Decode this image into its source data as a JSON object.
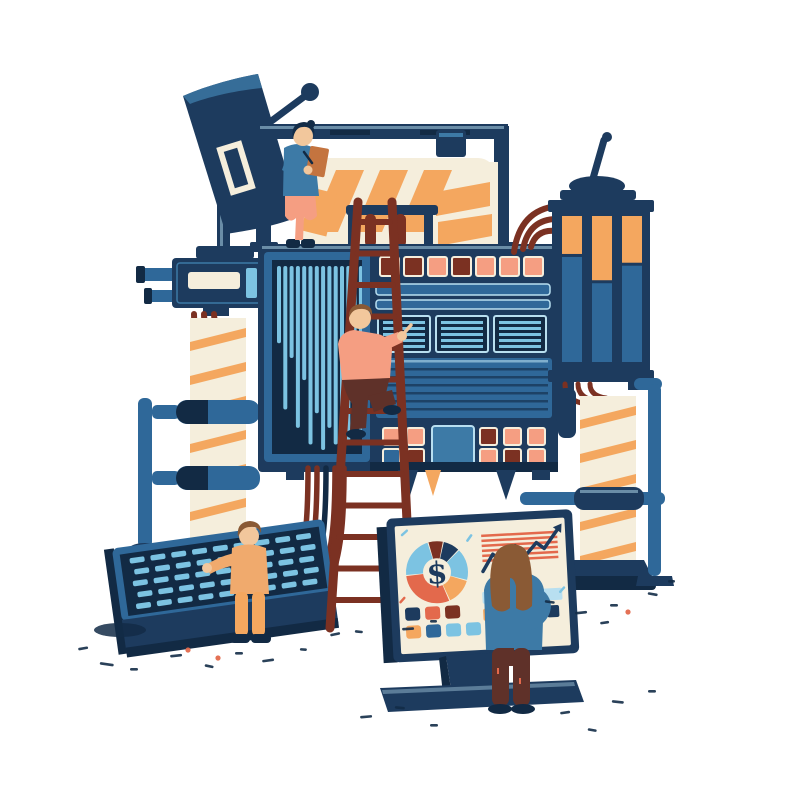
{
  "scene": {
    "description": "Hand-drawn illustration: four workers operate a large blue data machine (satellite dish, gauges, paper feed, ladder, console keyboard) feeding an analytics dashboard screen",
    "background": "#ffffff"
  },
  "palette": {
    "navy": "#1d3b5e",
    "navydk": "#122a44",
    "blue": "#2f6899",
    "steel": "#3d7aa6",
    "lightblue": "#7cc3e2",
    "paleblue": "#b8dff0",
    "cream": "#f5eedc",
    "orange": "#f4a75f",
    "coral": "#e3694c",
    "salmon": "#f59e82",
    "maroon": "#7b3122",
    "brown": "#8a5a35",
    "darkbrown": "#5f3129",
    "sienna": "#c4743f",
    "skin": "#f2c79c",
    "tan": "#f0aa6d",
    "ink": "#132c47"
  },
  "dashboard": {
    "donut": {
      "center_label": "$",
      "cx": 438,
      "cy": 570,
      "inner_r": 14,
      "outer_r": 31,
      "start": -14,
      "gap_deg": 2,
      "segments": [
        {
          "value": 8,
          "color": "maroon"
        },
        {
          "value": 9,
          "color": "navy"
        },
        {
          "value": 17,
          "color": "lightblue"
        },
        {
          "value": 14,
          "color": "orange"
        },
        {
          "value": 30,
          "color": "coral"
        },
        {
          "value": 22,
          "color": "lightblue"
        }
      ]
    },
    "trend": {
      "x": 484,
      "y": 530,
      "w": 76,
      "h": 52,
      "stripe_count": 6,
      "points": [
        [
          0,
          80
        ],
        [
          14,
          48
        ],
        [
          28,
          66
        ],
        [
          44,
          34
        ],
        [
          58,
          52
        ],
        [
          72,
          30
        ],
        [
          82,
          42
        ],
        [
          100,
          8
        ]
      ]
    },
    "swatches": {
      "x": 404,
      "y": 604,
      "size": 15,
      "gap": 5,
      "rows": [
        [
          "navy",
          "coral",
          "maroon"
        ],
        [
          "orange",
          "blue",
          "lightblue",
          "lightblue"
        ]
      ]
    },
    "bar_rows": [
      {
        "x": 482,
        "y": 592,
        "h": 12,
        "gap": 4,
        "segments": [
          {
            "w": 80,
            "color": "paleblue"
          }
        ]
      },
      {
        "x": 482,
        "y": 609,
        "h": 12,
        "gap": 4,
        "segments": [
          {
            "w": 20,
            "color": "orange"
          },
          {
            "w": 16,
            "color": "lightblue"
          },
          {
            "w": 16,
            "color": "lightblue"
          },
          {
            "w": 12,
            "color": "navy"
          }
        ]
      }
    ]
  },
  "chart_data": [
    {
      "type": "pie",
      "title": "dashboard donut chart with dollar sign",
      "center_label": "$",
      "values": [
        8,
        9,
        17,
        14,
        30,
        22
      ],
      "colors": [
        "maroon",
        "navy",
        "lightblue",
        "orange",
        "coral",
        "lightblue"
      ]
    },
    {
      "type": "line",
      "title": "dashboard trend chart over striped background",
      "trend": "upward, arrow at end",
      "points_pct": [
        [
          0,
          80
        ],
        [
          14,
          48
        ],
        [
          28,
          66
        ],
        [
          44,
          34
        ],
        [
          58,
          52
        ],
        [
          72,
          30
        ],
        [
          82,
          42
        ],
        [
          100,
          8
        ]
      ]
    }
  ],
  "machine": {
    "bar_panel": {
      "x": 277,
      "y": 266,
      "bar_w": 4,
      "step": 6.3,
      "max_h": 184,
      "heights": [
        0.42,
        0.78,
        0.5,
        0.88,
        0.62,
        0.97,
        0.8,
        1.0,
        0.88,
        0.97,
        0.9,
        0.97,
        0.78,
        0.9
      ]
    },
    "vents": {
      "xs": [
        378,
        436,
        494
      ],
      "y": 316,
      "w": 52,
      "h": 36,
      "slats": 5
    },
    "grooves": {
      "x": 380,
      "y": 368,
      "w": 168,
      "count": 6,
      "step": 8
    },
    "buttons_top": {
      "y": 257,
      "size": 19,
      "items": [
        {
          "x": 380,
          "c": "maroon"
        },
        {
          "x": 404,
          "c": "maroon"
        },
        {
          "x": 428,
          "c": "salmon"
        },
        {
          "x": 452,
          "c": "maroon"
        },
        {
          "x": 476,
          "c": "salmon"
        },
        {
          "x": 500,
          "c": "salmon"
        },
        {
          "x": 524,
          "c": "salmon"
        }
      ]
    },
    "buttons_bottom": [
      {
        "y": 428,
        "size": 17,
        "items": [
          {
            "x": 383,
            "c": "salmon"
          },
          {
            "x": 407,
            "c": "salmon"
          },
          {
            "x": 480,
            "c": "maroon"
          },
          {
            "x": 504,
            "c": "salmon"
          },
          {
            "x": 528,
            "c": "salmon"
          }
        ]
      },
      {
        "y": 449,
        "size": 17,
        "items": [
          {
            "x": 383,
            "c": "blue"
          },
          {
            "x": 407,
            "c": "maroon"
          },
          {
            "x": 480,
            "c": "salmon"
          },
          {
            "x": 504,
            "c": "maroon"
          },
          {
            "x": 528,
            "c": "salmon"
          }
        ]
      }
    ],
    "cables": {
      "x0": 308,
      "step": 9,
      "colors": [
        "maroon",
        "maroon",
        "navydk",
        "maroon",
        "maroon"
      ]
    }
  },
  "tower": {
    "tubes_x": [
      562,
      592,
      622
    ],
    "tube_w": 20,
    "y": 216,
    "h": 146,
    "fill_levels": [
      0.26,
      0.44,
      0.32
    ]
  },
  "ladder": {
    "rungs": 13,
    "top_y": 202,
    "bottom_y": 628,
    "left_top_x": 358,
    "left_bottom_x": 330,
    "right_top_x": 392,
    "right_bottom_x": 412
  },
  "keyboard": {
    "rows": 5,
    "cols": 9,
    "key_w": 15,
    "key_h": 5.5,
    "step_x": 21,
    "step_y": 11.5,
    "x0": 24,
    "y0": 40
  },
  "columns": {
    "left": {
      "x": 190,
      "y": 318,
      "w": 56,
      "h": 238
    },
    "right": {
      "x": 580,
      "y": 396,
      "w": 56,
      "h": 170
    },
    "stripe_step": 34
  },
  "figures": [
    {
      "id": "inspector",
      "pose": "standing on machine top writing on clipboard",
      "shirt": "steel",
      "pants": "salmon",
      "hair": "black"
    },
    {
      "id": "climber",
      "pose": "climbing ladder, pointing at machine vents",
      "shirt": "salmon",
      "pants": "darkbrown",
      "hair": "brown"
    },
    {
      "id": "operator",
      "pose": "working at console keyboard",
      "shirt": "tan",
      "pants": "orange",
      "hair": "brown"
    },
    {
      "id": "analyst",
      "pose": "viewing dashboard screen, hand on hip",
      "shirt": "steel",
      "pants": "darkbrown",
      "hair": "brown"
    }
  ]
}
